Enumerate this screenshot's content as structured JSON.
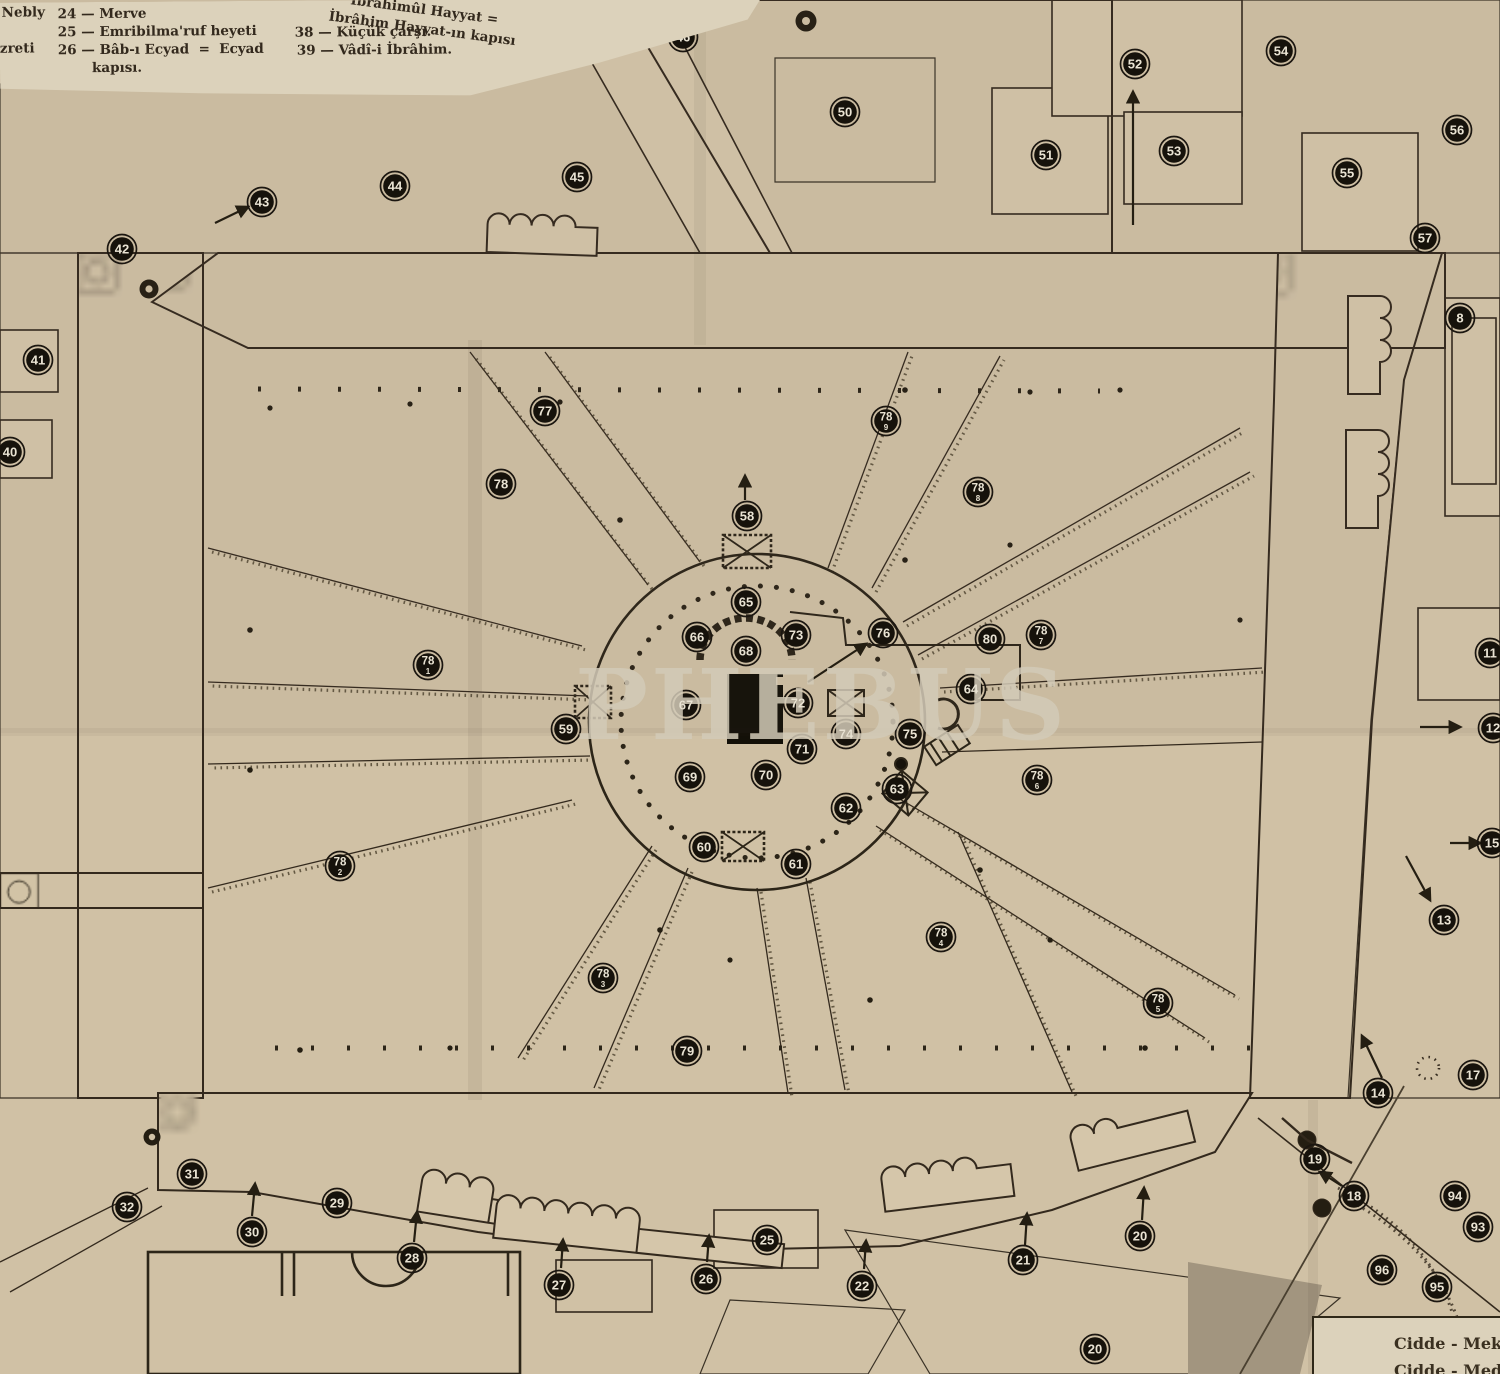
{
  "document": {
    "watermark": "PHEBUS",
    "description": "Plan of Masjid al-Haram (Mekke) — old Turkish printed map"
  },
  "colors": {
    "paper": "#d0c1a5",
    "legend_paper": "#dcd2bb",
    "ink": "#33291d",
    "marker_fill": "#16120b",
    "marker_text": "#e9e3d3",
    "hatch_base": "#c8b99d",
    "dark_underlay": "#a2957f"
  },
  "legend": {
    "frag_left_1": "Nebly",
    "frag_left_2": "zreti",
    "col1": [
      "24 — Merve",
      "25 — Emribilma'ruf heyeti",
      "26 — Bâb-ı Ecyad  =  Ecyad",
      "kapısı."
    ],
    "col2": [
      "38 — Küçük çarşı.",
      "39 — Vâdî-i İbrâhim."
    ],
    "rotated_frag": [
      "İbrâhimûl Hayyat =",
      "İbrâhim Hayyat-ın kapısı"
    ]
  },
  "roads_box": {
    "line1": "Cidde - Mekke",
    "line2": "Cidde - Medine"
  },
  "map": {
    "markers": [
      {
        "label": "46",
        "x": 683,
        "y": 37
      },
      {
        "label": "50",
        "x": 845,
        "y": 112
      },
      {
        "label": "52",
        "x": 1135,
        "y": 64
      },
      {
        "label": "54",
        "x": 1281,
        "y": 51
      },
      {
        "label": "51",
        "x": 1046,
        "y": 155
      },
      {
        "label": "53",
        "x": 1174,
        "y": 151
      },
      {
        "label": "56",
        "x": 1457,
        "y": 130
      },
      {
        "label": "55",
        "x": 1347,
        "y": 173
      },
      {
        "label": "57",
        "x": 1425,
        "y": 238
      },
      {
        "label": "45",
        "x": 577,
        "y": 177
      },
      {
        "label": "44",
        "x": 395,
        "y": 186
      },
      {
        "label": "43",
        "x": 262,
        "y": 202
      },
      {
        "label": "42",
        "x": 122,
        "y": 249
      },
      {
        "label": "41",
        "x": 38,
        "y": 360
      },
      {
        "label": "40",
        "x": 10,
        "y": 452
      },
      {
        "label": "8",
        "x": 1460,
        "y": 318
      },
      {
        "label": "77",
        "x": 545,
        "y": 411
      },
      {
        "label": "78",
        "sub": "9",
        "x": 886,
        "y": 421
      },
      {
        "label": "78",
        "x": 501,
        "y": 484
      },
      {
        "label": "78",
        "sub": "8",
        "x": 978,
        "y": 492
      },
      {
        "label": "58",
        "x": 747,
        "y": 516
      },
      {
        "label": "11",
        "x": 1490,
        "y": 653
      },
      {
        "label": "65",
        "x": 746,
        "y": 602
      },
      {
        "label": "66",
        "x": 697,
        "y": 637
      },
      {
        "label": "73",
        "x": 796,
        "y": 635
      },
      {
        "label": "76",
        "x": 883,
        "y": 633
      },
      {
        "label": "80",
        "x": 990,
        "y": 639
      },
      {
        "label": "78",
        "sub": "7",
        "x": 1041,
        "y": 635
      },
      {
        "label": "68",
        "x": 746,
        "y": 651
      },
      {
        "label": "78",
        "sub": "1",
        "x": 428,
        "y": 665
      },
      {
        "label": "64",
        "x": 971,
        "y": 689
      },
      {
        "label": "67",
        "x": 686,
        "y": 705
      },
      {
        "label": "72",
        "x": 798,
        "y": 703
      },
      {
        "label": "59",
        "x": 566,
        "y": 729
      },
      {
        "label": "12",
        "x": 1493,
        "y": 728
      },
      {
        "label": "74",
        "x": 846,
        "y": 734
      },
      {
        "label": "75",
        "x": 910,
        "y": 734
      },
      {
        "label": "71",
        "x": 802,
        "y": 749
      },
      {
        "label": "69",
        "x": 690,
        "y": 777
      },
      {
        "label": "70",
        "x": 766,
        "y": 775
      },
      {
        "label": "78",
        "sub": "6",
        "x": 1037,
        "y": 780
      },
      {
        "label": "63",
        "x": 897,
        "y": 789
      },
      {
        "label": "62",
        "x": 846,
        "y": 808
      },
      {
        "label": "15",
        "x": 1492,
        "y": 843
      },
      {
        "label": "60",
        "x": 704,
        "y": 847
      },
      {
        "label": "61",
        "x": 796,
        "y": 864
      },
      {
        "label": "78",
        "sub": "2",
        "x": 340,
        "y": 866
      },
      {
        "label": "13",
        "x": 1444,
        "y": 920
      },
      {
        "label": "78",
        "sub": "4",
        "x": 941,
        "y": 937
      },
      {
        "label": "78",
        "sub": "3",
        "x": 603,
        "y": 978
      },
      {
        "label": "78",
        "sub": "5",
        "x": 1158,
        "y": 1003
      },
      {
        "label": "79",
        "x": 687,
        "y": 1051
      },
      {
        "label": "17",
        "x": 1473,
        "y": 1075
      },
      {
        "label": "14",
        "x": 1378,
        "y": 1093
      },
      {
        "label": "19",
        "x": 1315,
        "y": 1159
      },
      {
        "label": "31",
        "x": 192,
        "y": 1174
      },
      {
        "label": "18",
        "x": 1354,
        "y": 1196
      },
      {
        "label": "94",
        "x": 1455,
        "y": 1196
      },
      {
        "label": "32",
        "x": 127,
        "y": 1207
      },
      {
        "label": "29",
        "x": 337,
        "y": 1203
      },
      {
        "label": "30",
        "x": 252,
        "y": 1232
      },
      {
        "label": "93",
        "x": 1478,
        "y": 1227
      },
      {
        "label": "28",
        "x": 412,
        "y": 1258
      },
      {
        "label": "96",
        "x": 1382,
        "y": 1270
      },
      {
        "label": "20",
        "x": 1140,
        "y": 1236
      },
      {
        "label": "95",
        "x": 1437,
        "y": 1287
      },
      {
        "label": "27",
        "x": 559,
        "y": 1285
      },
      {
        "label": "26",
        "x": 706,
        "y": 1279
      },
      {
        "label": "25",
        "x": 767,
        "y": 1240
      },
      {
        "label": "22",
        "x": 862,
        "y": 1286
      },
      {
        "label": "21",
        "x": 1023,
        "y": 1260
      },
      {
        "label": "20",
        "x": 1095,
        "y": 1349
      }
    ],
    "arrows": [
      [
        1133,
        225,
        1133,
        92
      ],
      [
        215,
        223,
        248,
        207
      ],
      [
        808,
        682,
        866,
        644
      ],
      [
        252,
        1216,
        255,
        1184
      ],
      [
        414,
        1242,
        417,
        1212
      ],
      [
        561,
        1268,
        563,
        1240
      ],
      [
        707,
        1262,
        709,
        1236
      ],
      [
        864,
        1269,
        866,
        1241
      ],
      [
        1025,
        1245,
        1027,
        1214
      ],
      [
        1142,
        1220,
        1144,
        1188
      ],
      [
        1382,
        1078,
        1362,
        1036
      ],
      [
        1342,
        1186,
        1320,
        1172
      ],
      [
        1420,
        727,
        1460,
        727
      ],
      [
        1450,
        843,
        1480,
        843
      ],
      [
        1406,
        856,
        1430,
        900
      ],
      [
        745,
        500,
        745,
        476
      ]
    ]
  }
}
